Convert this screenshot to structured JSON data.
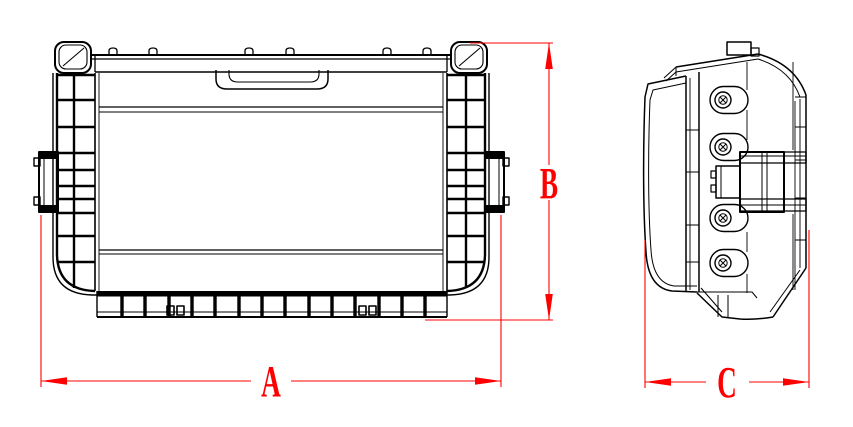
{
  "drawing": {
    "background_color": "#ffffff",
    "line_color": "#000000",
    "dimension_color": "#ff0000",
    "views": [
      {
        "id": "front-view",
        "label": "front elevation of ribbed case"
      },
      {
        "id": "side-view",
        "label": "side profile of case"
      }
    ],
    "dimensions": [
      {
        "label": "A",
        "axis": "horizontal",
        "refers_to": "front view overall width"
      },
      {
        "label": "B",
        "axis": "vertical",
        "refers_to": "front view overall height"
      },
      {
        "label": "C",
        "axis": "horizontal",
        "refers_to": "side view overall depth"
      }
    ]
  }
}
